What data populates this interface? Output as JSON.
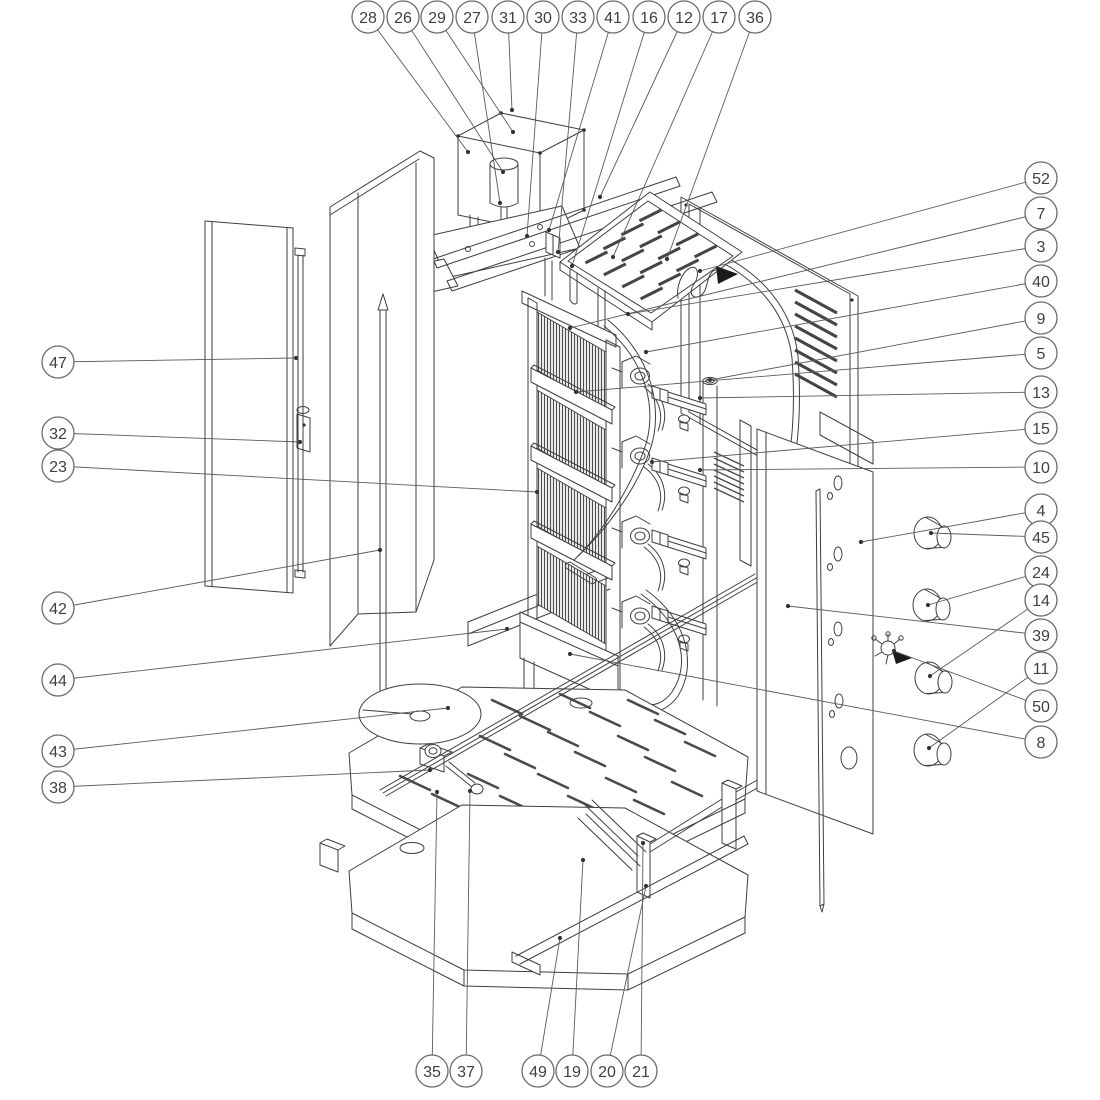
{
  "diagram": {
    "type": "exploded-parts-diagram",
    "subject": "Vertical gas doner kebab grill - exploded assembly drawing with numbered part callouts",
    "background_color": "#ffffff",
    "line_color": "#3f3f3f",
    "balloon": {
      "radius": 16,
      "stroke": "#6a6a6a",
      "fill": "#ffffff",
      "text_color": "#3f3f3f"
    },
    "callouts": [
      {
        "num": "28",
        "bx": 368,
        "by": 17,
        "tx": 468,
        "ty": 152
      },
      {
        "num": "26",
        "bx": 403,
        "by": 17,
        "tx": 503,
        "ty": 172
      },
      {
        "num": "29",
        "bx": 437,
        "by": 17,
        "tx": 513,
        "ty": 132
      },
      {
        "num": "27",
        "bx": 472,
        "by": 17,
        "tx": 500,
        "ty": 203
      },
      {
        "num": "31",
        "bx": 508,
        "by": 17,
        "tx": 512,
        "ty": 110
      },
      {
        "num": "30",
        "bx": 543,
        "by": 17,
        "tx": 527,
        "ty": 236
      },
      {
        "num": "33",
        "bx": 578,
        "by": 17,
        "tx": 558,
        "ty": 252
      },
      {
        "num": "41",
        "bx": 613,
        "by": 17,
        "tx": 549,
        "ty": 230
      },
      {
        "num": "16",
        "bx": 649,
        "by": 17,
        "tx": 572,
        "ty": 266
      },
      {
        "num": "12",
        "bx": 684,
        "by": 17,
        "tx": 600,
        "ty": 197
      },
      {
        "num": "17",
        "bx": 719,
        "by": 17,
        "tx": 613,
        "ty": 257
      },
      {
        "num": "36",
        "bx": 755,
        "by": 17,
        "tx": 667,
        "ty": 259
      },
      {
        "num": "52",
        "bx": 1041,
        "by": 178,
        "tx": 700,
        "ty": 271
      },
      {
        "num": "7",
        "bx": 1041,
        "by": 213,
        "tx": 570,
        "ty": 328
      },
      {
        "num": "3",
        "bx": 1041,
        "by": 246,
        "tx": 628,
        "ty": 314
      },
      {
        "num": "40",
        "bx": 1041,
        "by": 281,
        "tx": 646,
        "ty": 352
      },
      {
        "num": "9",
        "bx": 1041,
        "by": 318,
        "tx": 710,
        "ty": 380
      },
      {
        "num": "5",
        "bx": 1041,
        "by": 353,
        "tx": 576,
        "ty": 392
      },
      {
        "num": "13",
        "bx": 1041,
        "by": 392,
        "tx": 700,
        "ty": 398
      },
      {
        "num": "15",
        "bx": 1041,
        "by": 428,
        "tx": 652,
        "ty": 462
      },
      {
        "num": "10",
        "bx": 1041,
        "by": 467,
        "tx": 700,
        "ty": 470
      },
      {
        "num": "4",
        "bx": 1041,
        "by": 510,
        "tx": 861,
        "ty": 542
      },
      {
        "num": "45",
        "bx": 1041,
        "by": 537,
        "tx": 931,
        "ty": 533
      },
      {
        "num": "24",
        "bx": 1041,
        "by": 572,
        "tx": 928,
        "ty": 605
      },
      {
        "num": "14",
        "bx": 1041,
        "by": 600,
        "tx": 930,
        "ty": 676
      },
      {
        "num": "39",
        "bx": 1041,
        "by": 635,
        "tx": 788,
        "ty": 606
      },
      {
        "num": "11",
        "bx": 1041,
        "by": 668,
        "tx": 929,
        "ty": 748
      },
      {
        "num": "50",
        "bx": 1041,
        "by": 706,
        "tx": 894,
        "ty": 651
      },
      {
        "num": "8",
        "bx": 1041,
        "by": 742,
        "tx": 570,
        "ty": 654
      },
      {
        "num": "47",
        "bx": 58,
        "by": 362,
        "tx": 296,
        "ty": 358
      },
      {
        "num": "32",
        "bx": 58,
        "by": 433,
        "tx": 300,
        "ty": 442
      },
      {
        "num": "23",
        "bx": 58,
        "by": 466,
        "tx": 537,
        "ty": 492
      },
      {
        "num": "42",
        "bx": 58,
        "by": 608,
        "tx": 380,
        "ty": 550
      },
      {
        "num": "44",
        "bx": 58,
        "by": 680,
        "tx": 507,
        "ty": 629
      },
      {
        "num": "43",
        "bx": 58,
        "by": 751,
        "tx": 448,
        "ty": 708
      },
      {
        "num": "38",
        "bx": 58,
        "by": 787,
        "tx": 430,
        "ty": 770
      },
      {
        "num": "35",
        "bx": 432,
        "by": 1071,
        "tx": 437,
        "ty": 792
      },
      {
        "num": "37",
        "bx": 466,
        "by": 1071,
        "tx": 470,
        "ty": 791
      },
      {
        "num": "49",
        "bx": 538,
        "by": 1071,
        "tx": 560,
        "ty": 938
      },
      {
        "num": "19",
        "bx": 572,
        "by": 1071,
        "tx": 583,
        "ty": 860
      },
      {
        "num": "20",
        "bx": 607,
        "by": 1071,
        "tx": 646,
        "ty": 886
      },
      {
        "num": "21",
        "bx": 641,
        "by": 1071,
        "tx": 643,
        "ty": 843
      }
    ]
  }
}
